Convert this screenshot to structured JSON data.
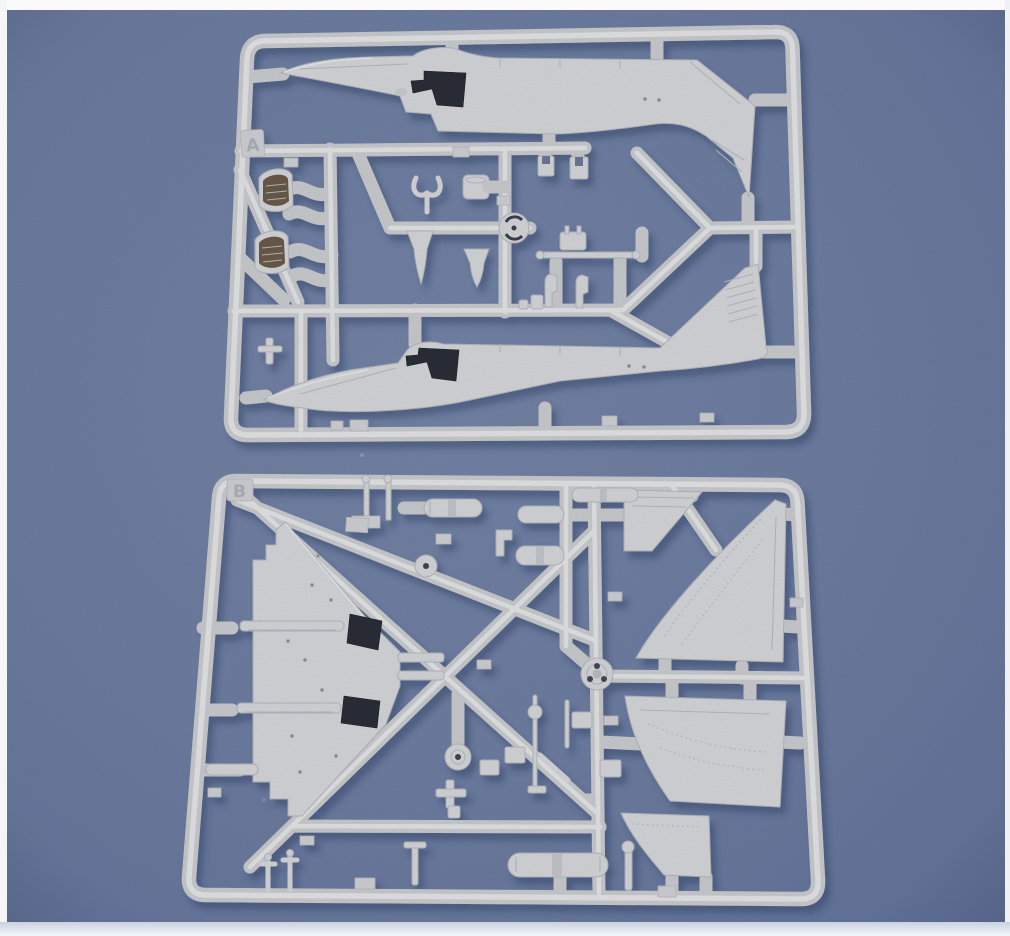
{
  "scene": {
    "description": "Product photograph of two light-grey injection-moulded plastic model-kit sprues for a small-scale A-4 Skyhawk style jet aircraft, lying on a slate-blue backdrop with white borders at the top and left edges and a pale strip along the bottom edge.",
    "colors": {
      "backdrop": "#6e7ea2",
      "backdrop_deep": "#63739a",
      "border_top": "#fafafa",
      "border_left": "#f5f6f8",
      "border_right": "#eef1f5",
      "border_bottom": "#e9edf3",
      "plastic": "#d6d7da",
      "runner": "#cacccf",
      "runner_highlight": "#e4e5e7",
      "part_edge": "#b3b8bf",
      "recess": "#2b2f38",
      "tub_interior": "#6a5a49",
      "cast_shadow": "#2f3f69"
    }
  },
  "sprues": [
    {
      "label": "A",
      "contents": [
        "port fuselage half",
        "starboard fuselage half",
        "cockpit tubs",
        "ejection seats",
        "intake cones",
        "exhaust pipe",
        "nose wheel",
        "actuator rod",
        "small fittings"
      ]
    },
    {
      "label": "B",
      "contents": [
        "one-piece lower wing",
        "upper wing skin left",
        "upper wing skin right",
        "wing flaps",
        "main wheels",
        "spoked wheel",
        "landing-gear struts",
        "drop-tank halves",
        "pylons",
        "antennas",
        "small fittings"
      ]
    }
  ]
}
